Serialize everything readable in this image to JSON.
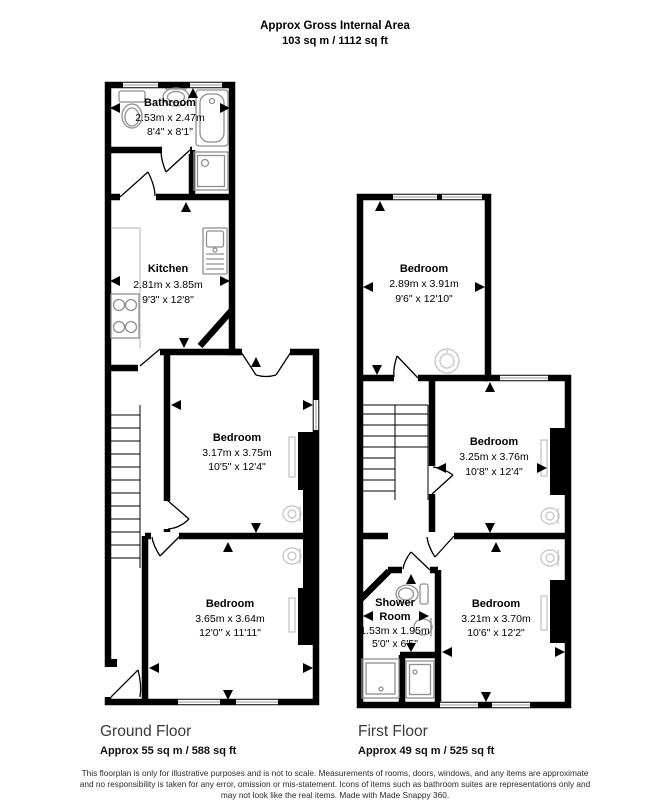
{
  "header": {
    "title": "Approx Gross Internal Area",
    "subtitle": "103 sq m / 1112 sq ft"
  },
  "ground_floor": {
    "label": "Ground Floor",
    "area": "Approx 55 sq m / 588 sq ft",
    "rooms": {
      "bathroom": {
        "name": "Bathroom",
        "dims_m": "2.53m x 2.47m",
        "dims_ft": "8'4\" x 8'1\""
      },
      "kitchen": {
        "name": "Kitchen",
        "dims_m": "2.81m x 3.85m",
        "dims_ft": "9'3\" x 12'8\""
      },
      "bedroom_middle": {
        "name": "Bedroom",
        "dims_m": "3.17m x 3.75m",
        "dims_ft": "10'5\" x 12'4\""
      },
      "bedroom_front": {
        "name": "Bedroom",
        "dims_m": "3.65m x 3.64m",
        "dims_ft": "12'0\" x 11'11\""
      }
    }
  },
  "first_floor": {
    "label": "First Floor",
    "area": "Approx 49 sq m / 525 sq ft",
    "rooms": {
      "bedroom_top": {
        "name": "Bedroom",
        "dims_m": "2.89m x 3.91m",
        "dims_ft": "9'6\" x 12'10\""
      },
      "bedroom_middle": {
        "name": "Bedroom",
        "dims_m": "3.25m x 3.76m",
        "dims_ft": "10'8\" x 12'4\""
      },
      "shower_room": {
        "name_line1": "Shower",
        "name_line2": "Room",
        "dims_m": "1.53m x 1.95m",
        "dims_ft": "5'0\" x 6'5\""
      },
      "bedroom_front": {
        "name": "Bedroom",
        "dims_m": "3.21m x 3.70m",
        "dims_ft": "10'6\" x 12'2\""
      }
    }
  },
  "footer": {
    "line1": "This floorplan is only for illustrative purposes and is not to scale. Measurements of rooms, doors, windows, and any items are approximate",
    "line2": "and no responsibility is taken for any error, omission or mis-statement. Icons of items such as bathroom suites are representations only and",
    "line3": "may not look like the real items. Made with Made Snappy 360."
  },
  "colors": {
    "wall": "#000000",
    "background": "#ffffff",
    "fixture": "#8f8f8f",
    "fixture_light": "#c2c2c2"
  }
}
